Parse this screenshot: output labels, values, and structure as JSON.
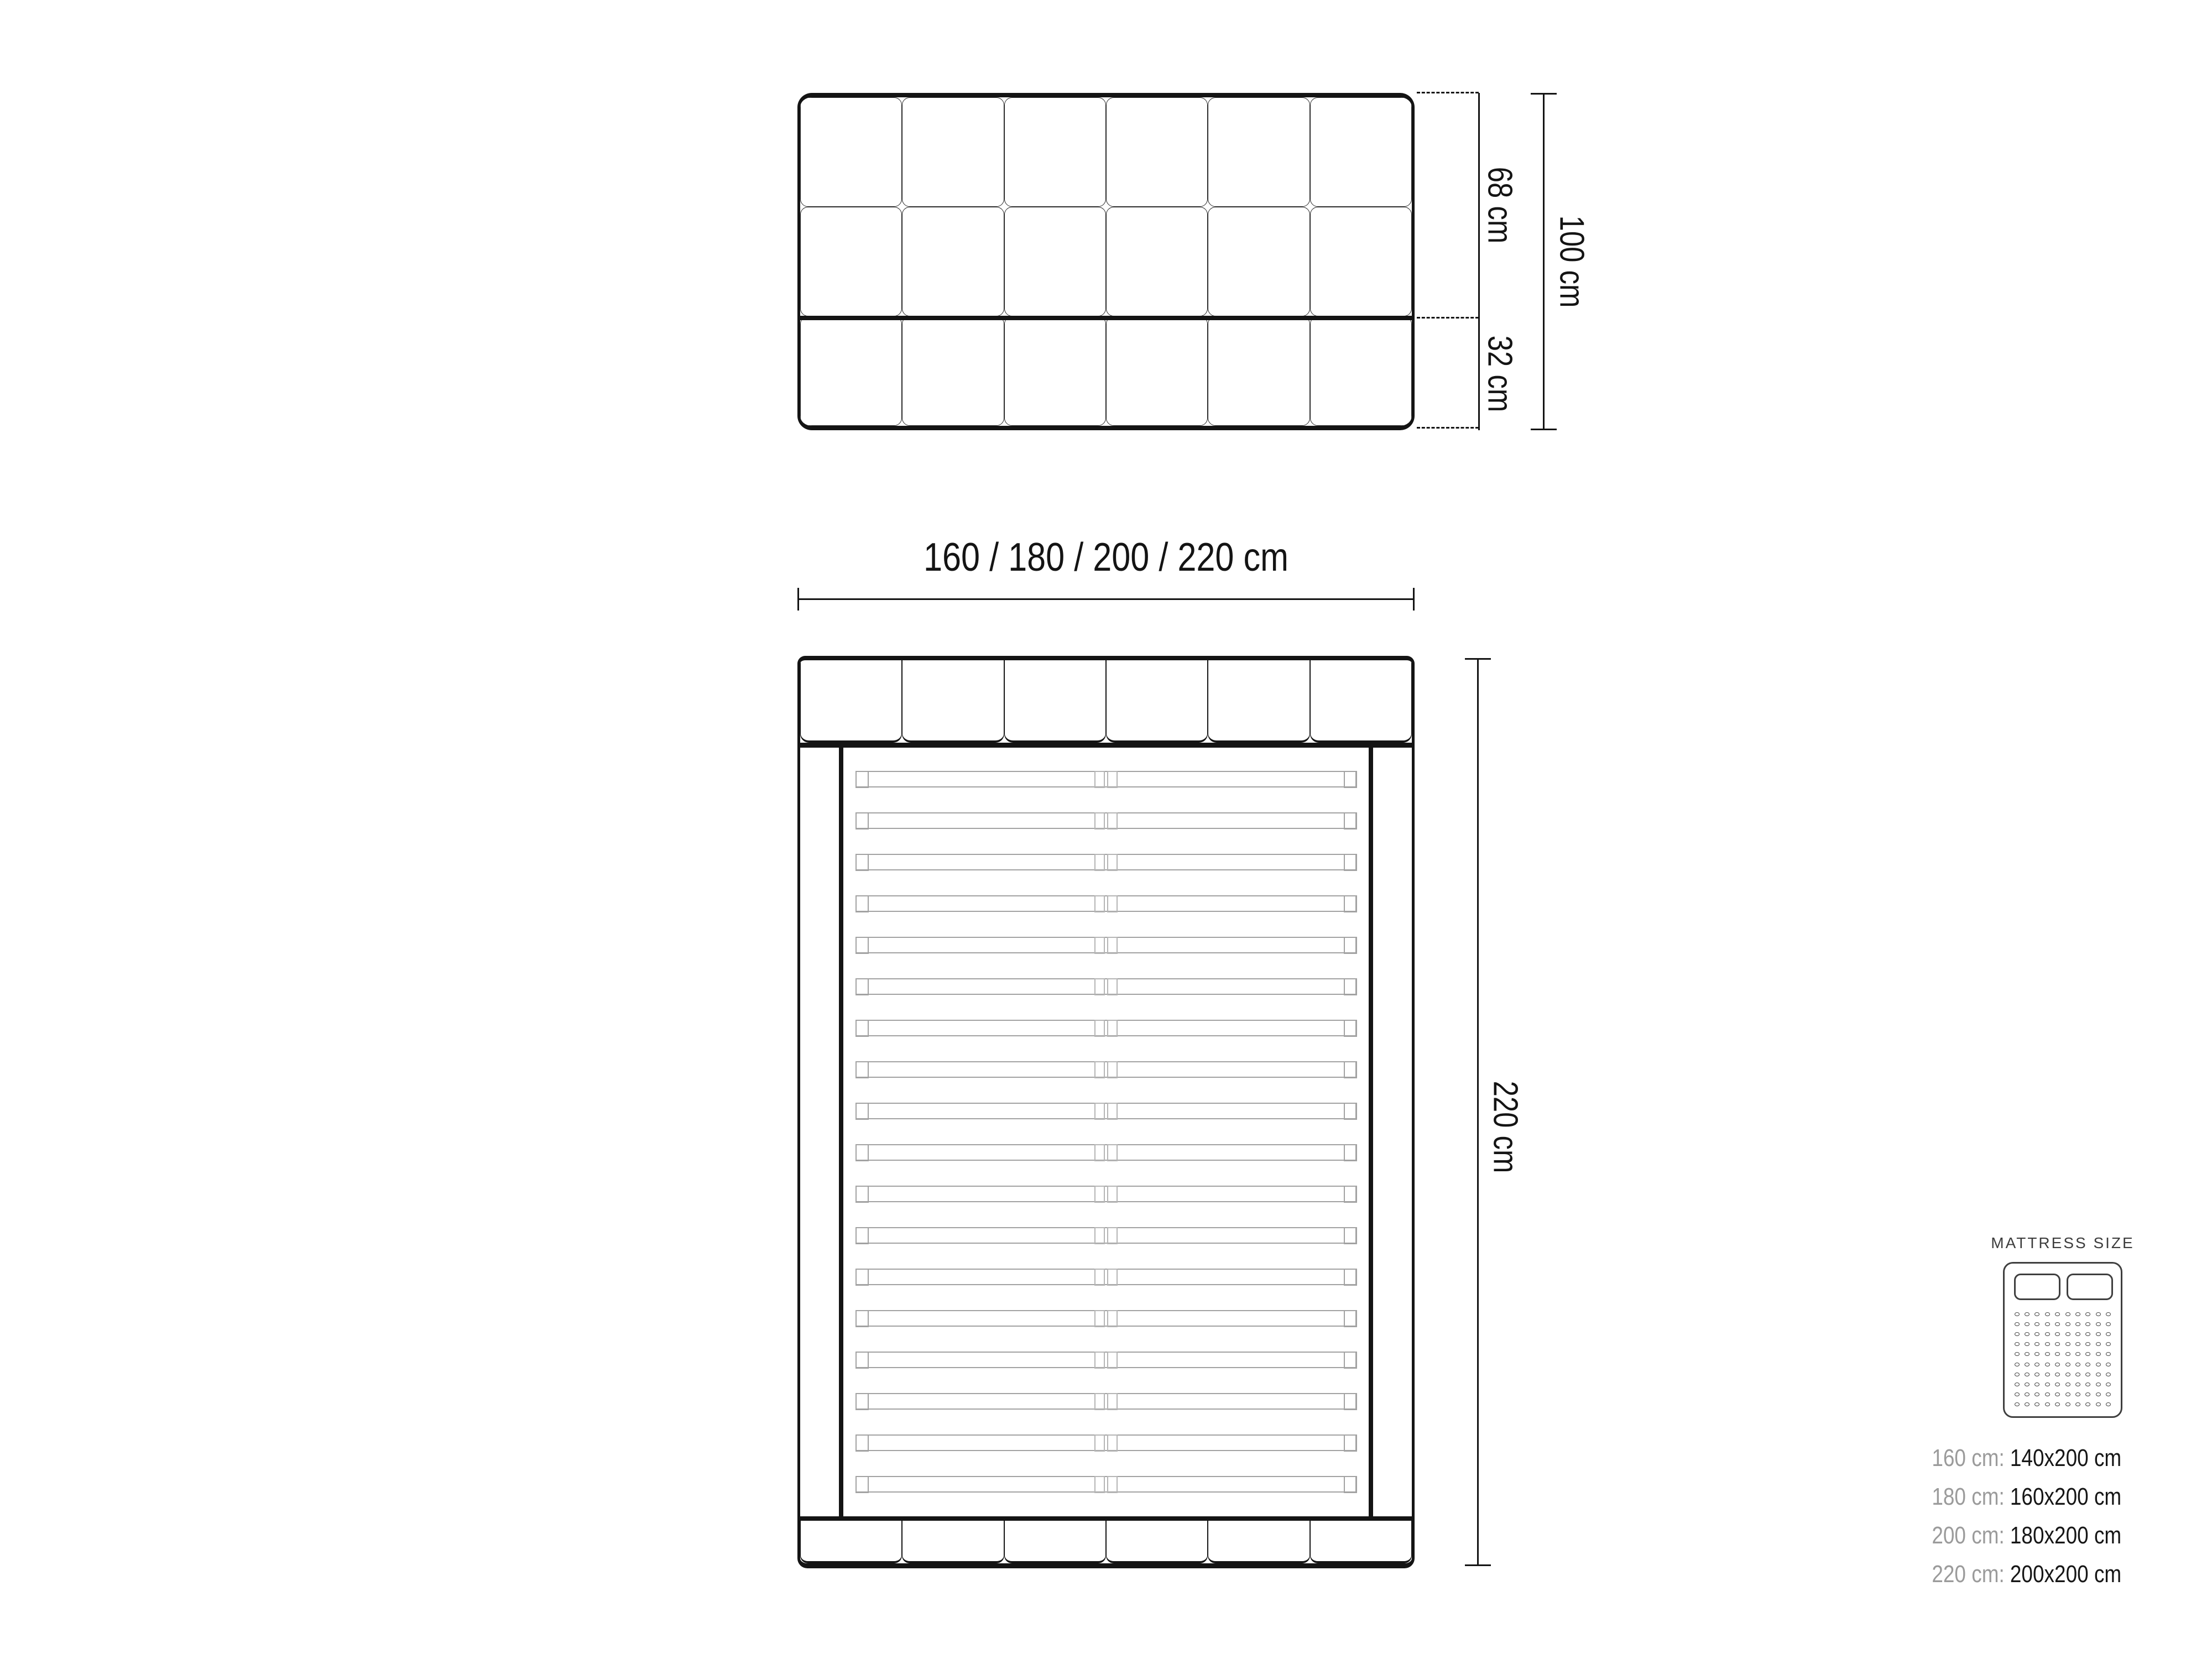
{
  "diagram": {
    "headboard_front": {
      "columns": 6,
      "rows": 3
    },
    "dim_upper_label": "68 cm",
    "dim_lower_label": "32 cm",
    "dim_total_label": "100 cm",
    "dim_width_label": "160 / 180 / 200 / 220 cm",
    "dim_length_label": "220 cm",
    "top_view": {
      "headboard_panels": 6,
      "footboard_panels": 6,
      "slat_count": 18
    }
  },
  "legend": {
    "title": "MATTRESS SIZE",
    "icon": {
      "pillows": 2,
      "dot_rows": 10,
      "dot_cols": 10
    },
    "rows": [
      {
        "label": "160 cm:",
        "value": "140x200 cm"
      },
      {
        "label": "180 cm:",
        "value": "160x200 cm"
      },
      {
        "label": "200 cm:",
        "value": "180x200 cm"
      },
      {
        "label": "220 cm:",
        "value": "200x200 cm"
      }
    ]
  },
  "colors": {
    "background": "#ffffff",
    "line": "#141414",
    "slat": "#a2a2a2",
    "legend_label": "#9b9b9b",
    "legend_value": "#161616",
    "legend_title": "#3d3d3d",
    "icon_line": "#3f3f3f"
  }
}
